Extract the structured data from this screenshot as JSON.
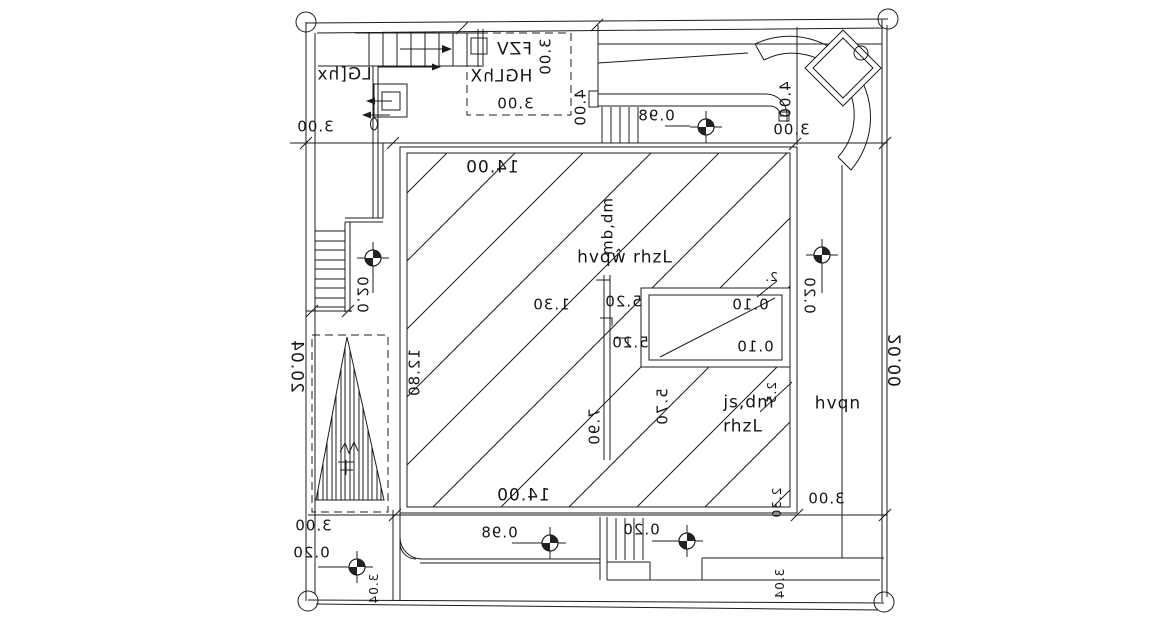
{
  "colors": {
    "line": "#1c1c1c",
    "text": "#151515",
    "background": "#ffffff"
  },
  "icons": {
    "survey_marker": "benchmark-crosshair-icon",
    "corner_marker": "boundary-circle-icon",
    "column": "diamond-column-icon"
  },
  "annotations": {
    "rooms": {
      "top_left": "LG[hx",
      "box_title": "FZV",
      "box_name": "HGLhX",
      "box_dim": "3.00",
      "box_dim_v": "3.00",
      "hall_note": "hvqŵ rhzL",
      "hall_note_v": "mb,dm",
      "br_note1": "js,dm",
      "br_note2": "rhzL",
      "corridor": "hvqn"
    },
    "dims": {
      "d300_tl": "3.00",
      "d400_l": "4.00",
      "d098_t": "0.98",
      "d400_r": "4.00",
      "d300_tr": "3.00",
      "d1400_t": "14.00",
      "d130": "1.30",
      "d1280": "12.80",
      "d520a": "5.20",
      "d520b": "5.20",
      "d010a": "0.10",
      "d010b": "0.10",
      "d2": "2.",
      "d020_r": "0.20",
      "d020_l": "0.20",
      "d2004": "20.04",
      "d2000": "20.00",
      "d570": "5.70",
      "d790": "7.90",
      "d25": "2.5",
      "d1400_b": "14.00",
      "d230": "2.30",
      "d300_br": "3.00",
      "d098_b": "0.98",
      "d020_bc": "0.20",
      "d300_bl": "3.00",
      "d020_bl": "0.20",
      "d304_l": "3.04",
      "d304_r": "3.04"
    }
  }
}
